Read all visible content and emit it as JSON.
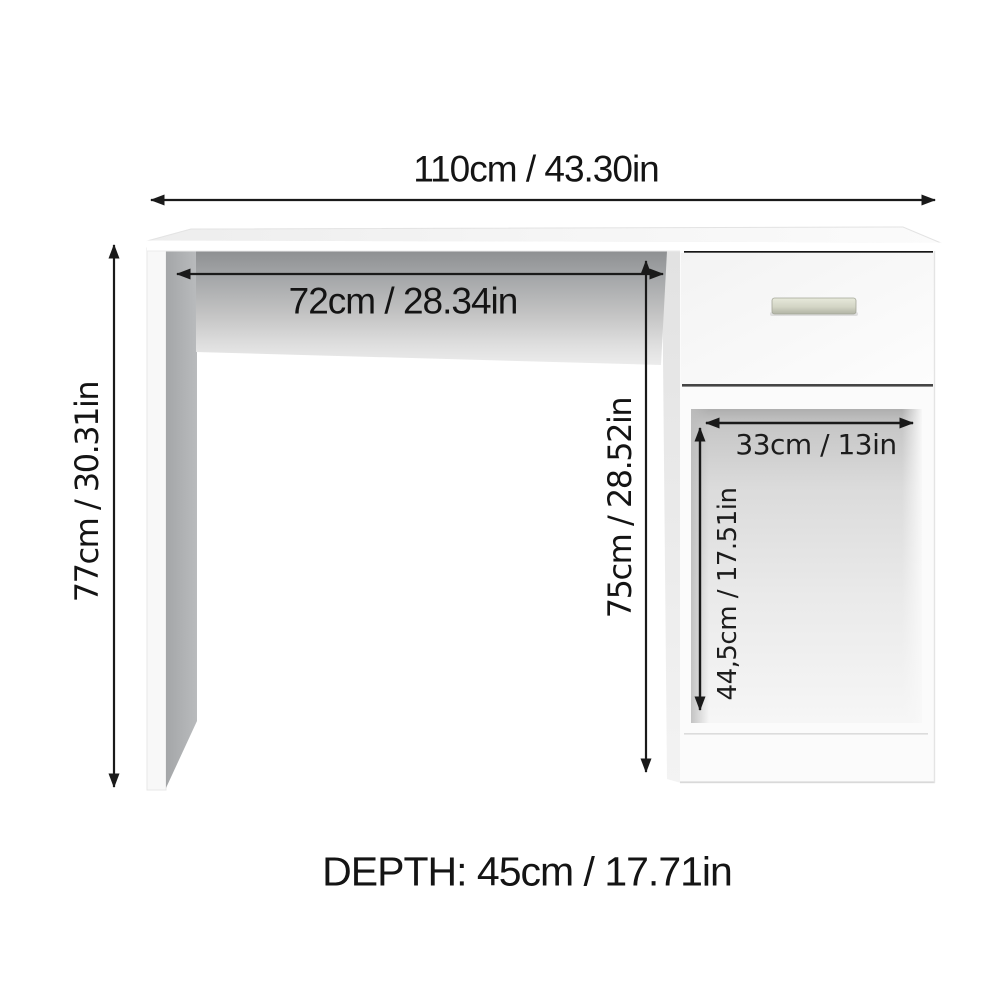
{
  "labels": {
    "total_width": "110cm / 43.30in",
    "knee_space_width": "72cm / 28.34in",
    "total_height": "77cm / 30.31in",
    "pedestal_height": "75cm / 28.52in",
    "compartment_width": "33cm / 13in",
    "compartment_height": "44,5cm / 17.51in",
    "depth": "DEPTH: 45cm / 17.71in"
  },
  "colors": {
    "background": "#ffffff",
    "dimension_line": "#1a1a1a",
    "text": "#141414",
    "desk_body": "#fbfbfb",
    "apron_shadow_top": "#8e9092",
    "leg_side_gray": "#abadaf",
    "drawer_gap_dark": "#161616",
    "handle_beige": "#d3d5c5"
  }
}
